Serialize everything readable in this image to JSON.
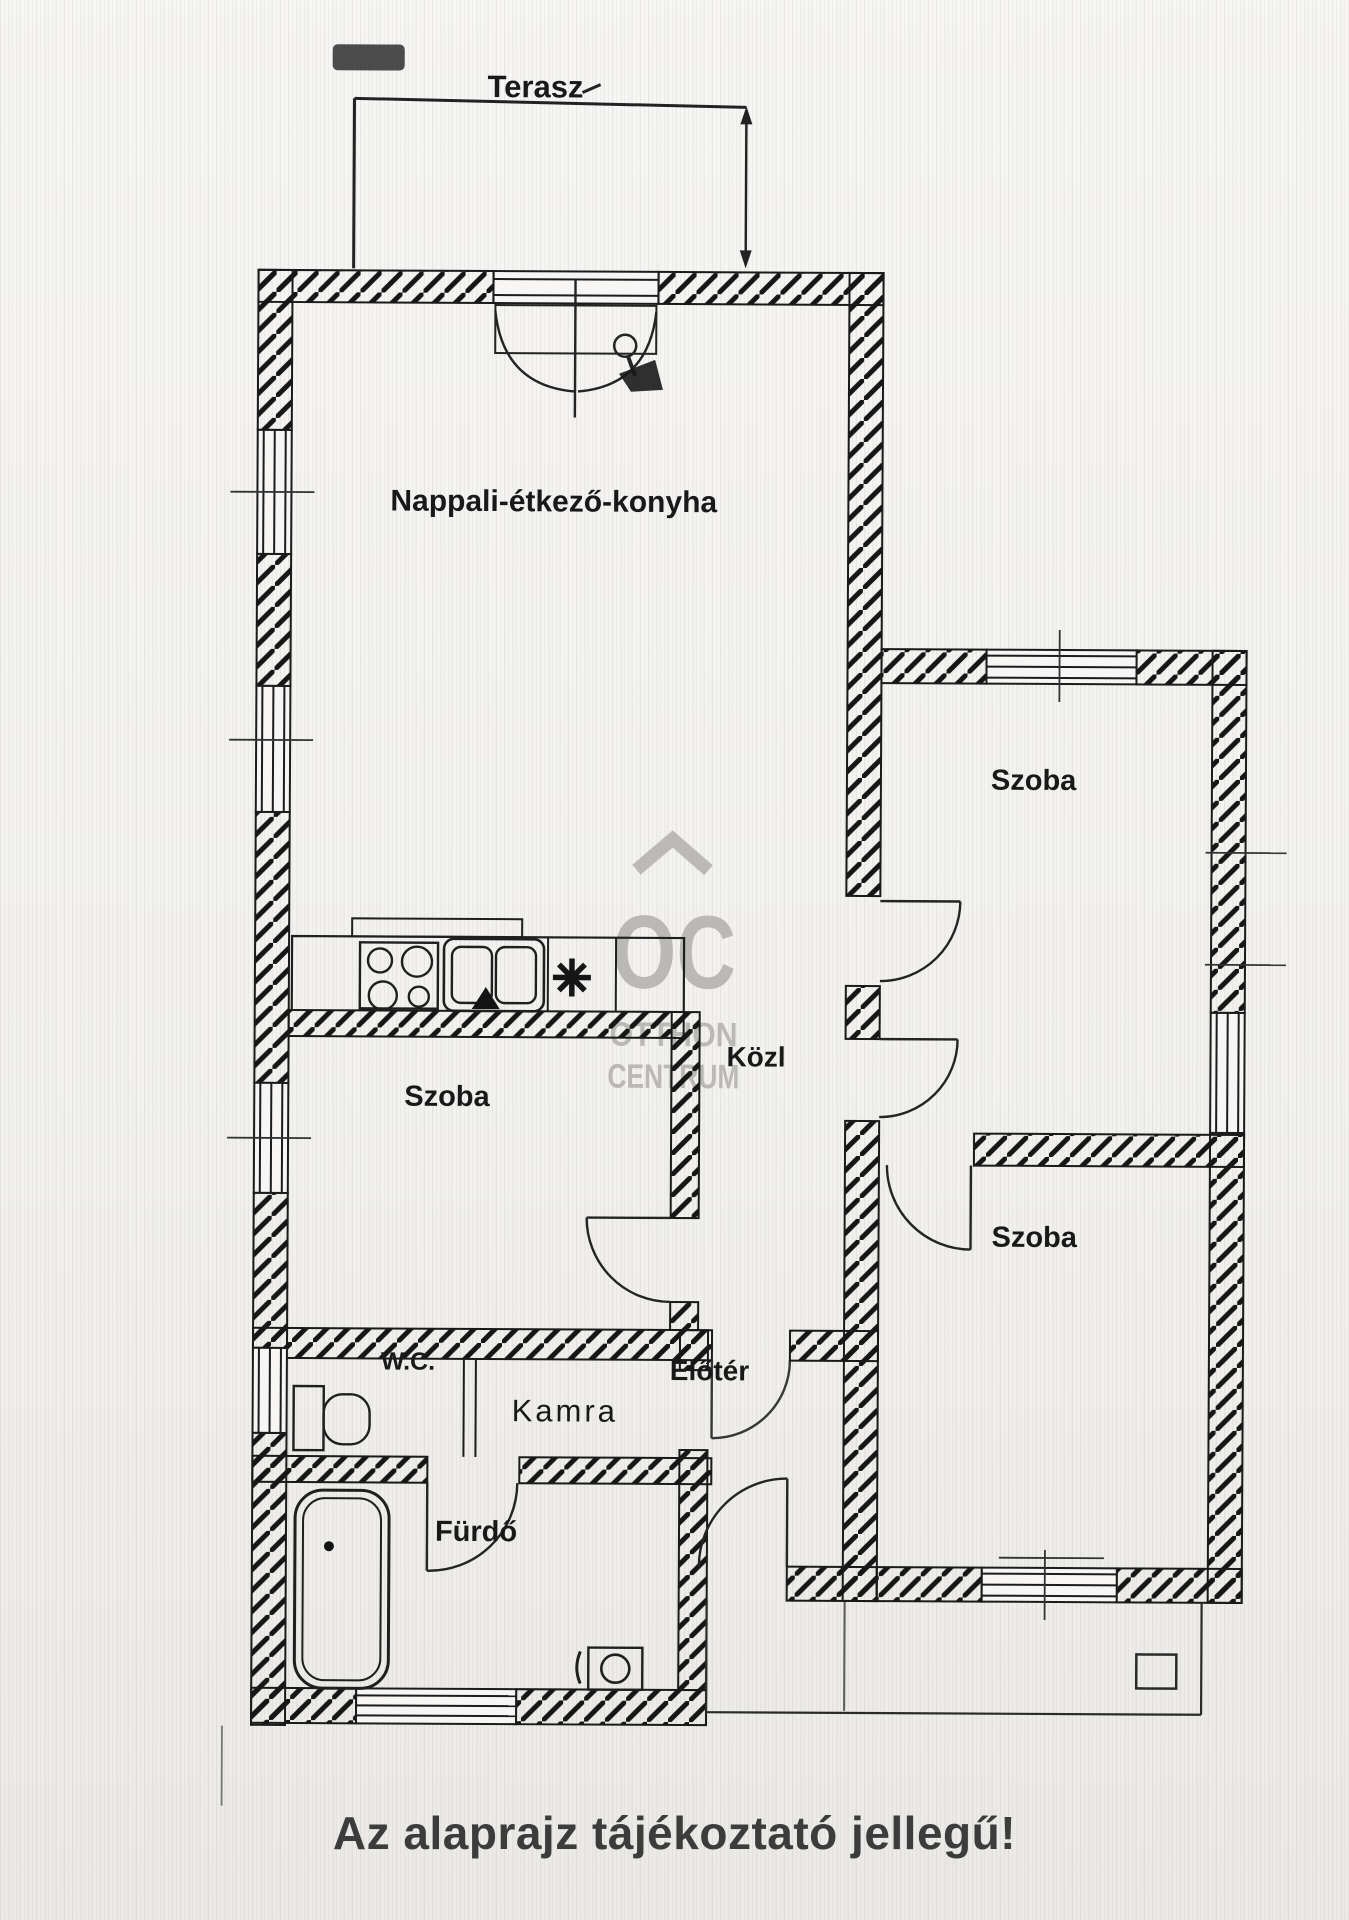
{
  "caption": {
    "text": "Az alaprajz tájékoztató jellegű!"
  },
  "watermark": {
    "initials": "OC",
    "line1": "OTTHON",
    "line2": "CENTRUM"
  },
  "labels": {
    "terasz": "Terasz",
    "nappali": "Nappali-étkező-konyha",
    "szoba_jobb_felso": "Szoba",
    "kozlekedo": "Közl",
    "szoba_bal": "Szoba",
    "szoba_jobb_also": "Szoba",
    "wc": "W.C.",
    "kamra": "Kamra",
    "eloter": "Előtér",
    "furdo": "Fürdő"
  },
  "colors": {
    "ink": "#191919",
    "watermark": "#b4b2af",
    "caption": "#3c3c3c",
    "paper": "#f4f3f0"
  }
}
